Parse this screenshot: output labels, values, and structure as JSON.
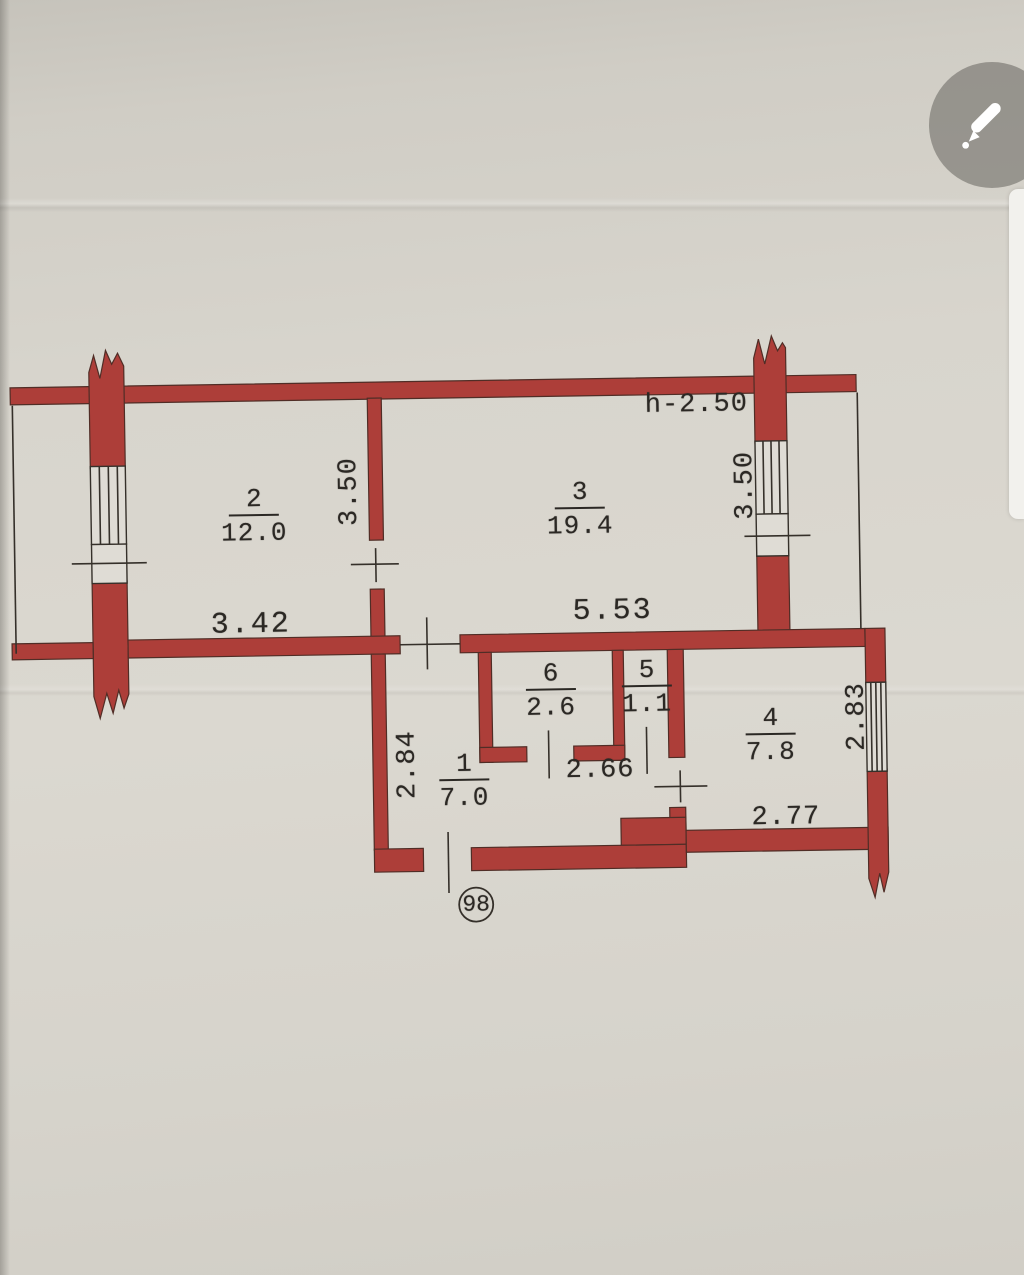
{
  "toolbar": {
    "edit_icon": "pencil-icon"
  },
  "floor_plan": {
    "height_note": "h-2.50",
    "unit_number": "98",
    "wall_color": "#ad3e39",
    "rooms": {
      "room1": {
        "number": "1",
        "area": "7.0"
      },
      "room2": {
        "number": "2",
        "area": "12.0"
      },
      "room3": {
        "number": "3",
        "area": "19.4"
      },
      "room4": {
        "number": "4",
        "area": "7.8"
      },
      "room5": {
        "number": "5",
        "area": "1.1"
      },
      "room6": {
        "number": "6",
        "area": "2.6"
      }
    },
    "dimensions": {
      "room2_width": "3.42",
      "room2_depth": "3.50",
      "room3_width": "5.53",
      "room3_depth": "3.50",
      "hall_depth": "2.84",
      "hall_width": "2.66",
      "room4_width": "2.77",
      "room4_depth": "2.83"
    }
  }
}
